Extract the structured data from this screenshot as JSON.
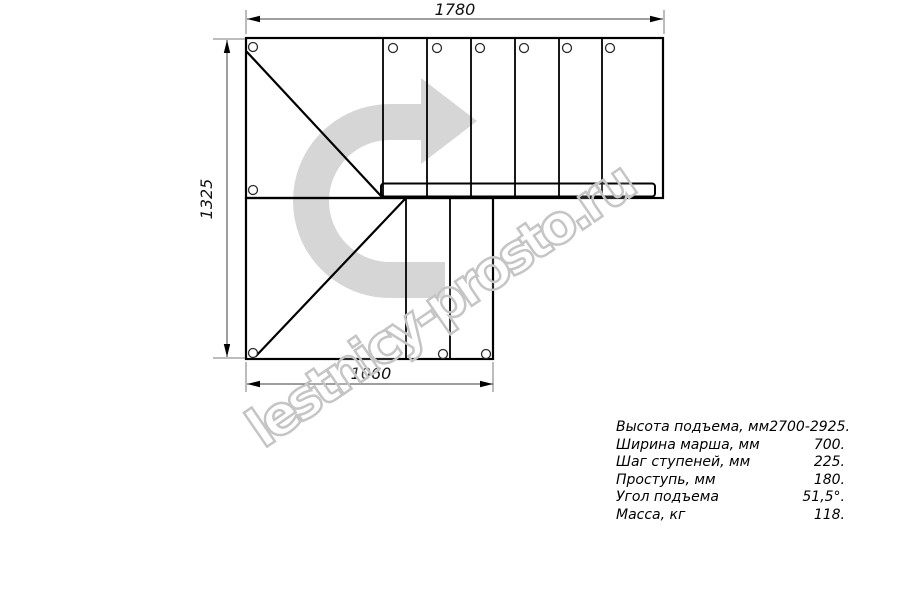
{
  "watermark": {
    "text": "lestnicy-prosto.ru",
    "color": "#c5c5c5"
  },
  "drawing": {
    "type": "staircase-plan-view",
    "dimensions": {
      "top": "1780",
      "left": "1325",
      "bottom": "1060"
    },
    "direction_arrow_color": "#d6d6d6",
    "line_color": "#000000"
  },
  "specs": {
    "rows": [
      {
        "label": "Высота подъема, мм",
        "value": "2700-2925."
      },
      {
        "label": "Ширина марша, мм",
        "value": "700."
      },
      {
        "label": "Шаг ступеней, мм",
        "value": "225."
      },
      {
        "label": "Проступь, мм",
        "value": "180."
      },
      {
        "label": "Угол подъема",
        "value": "51,5°."
      },
      {
        "label": "Масса, кг",
        "value": "118."
      }
    ]
  }
}
